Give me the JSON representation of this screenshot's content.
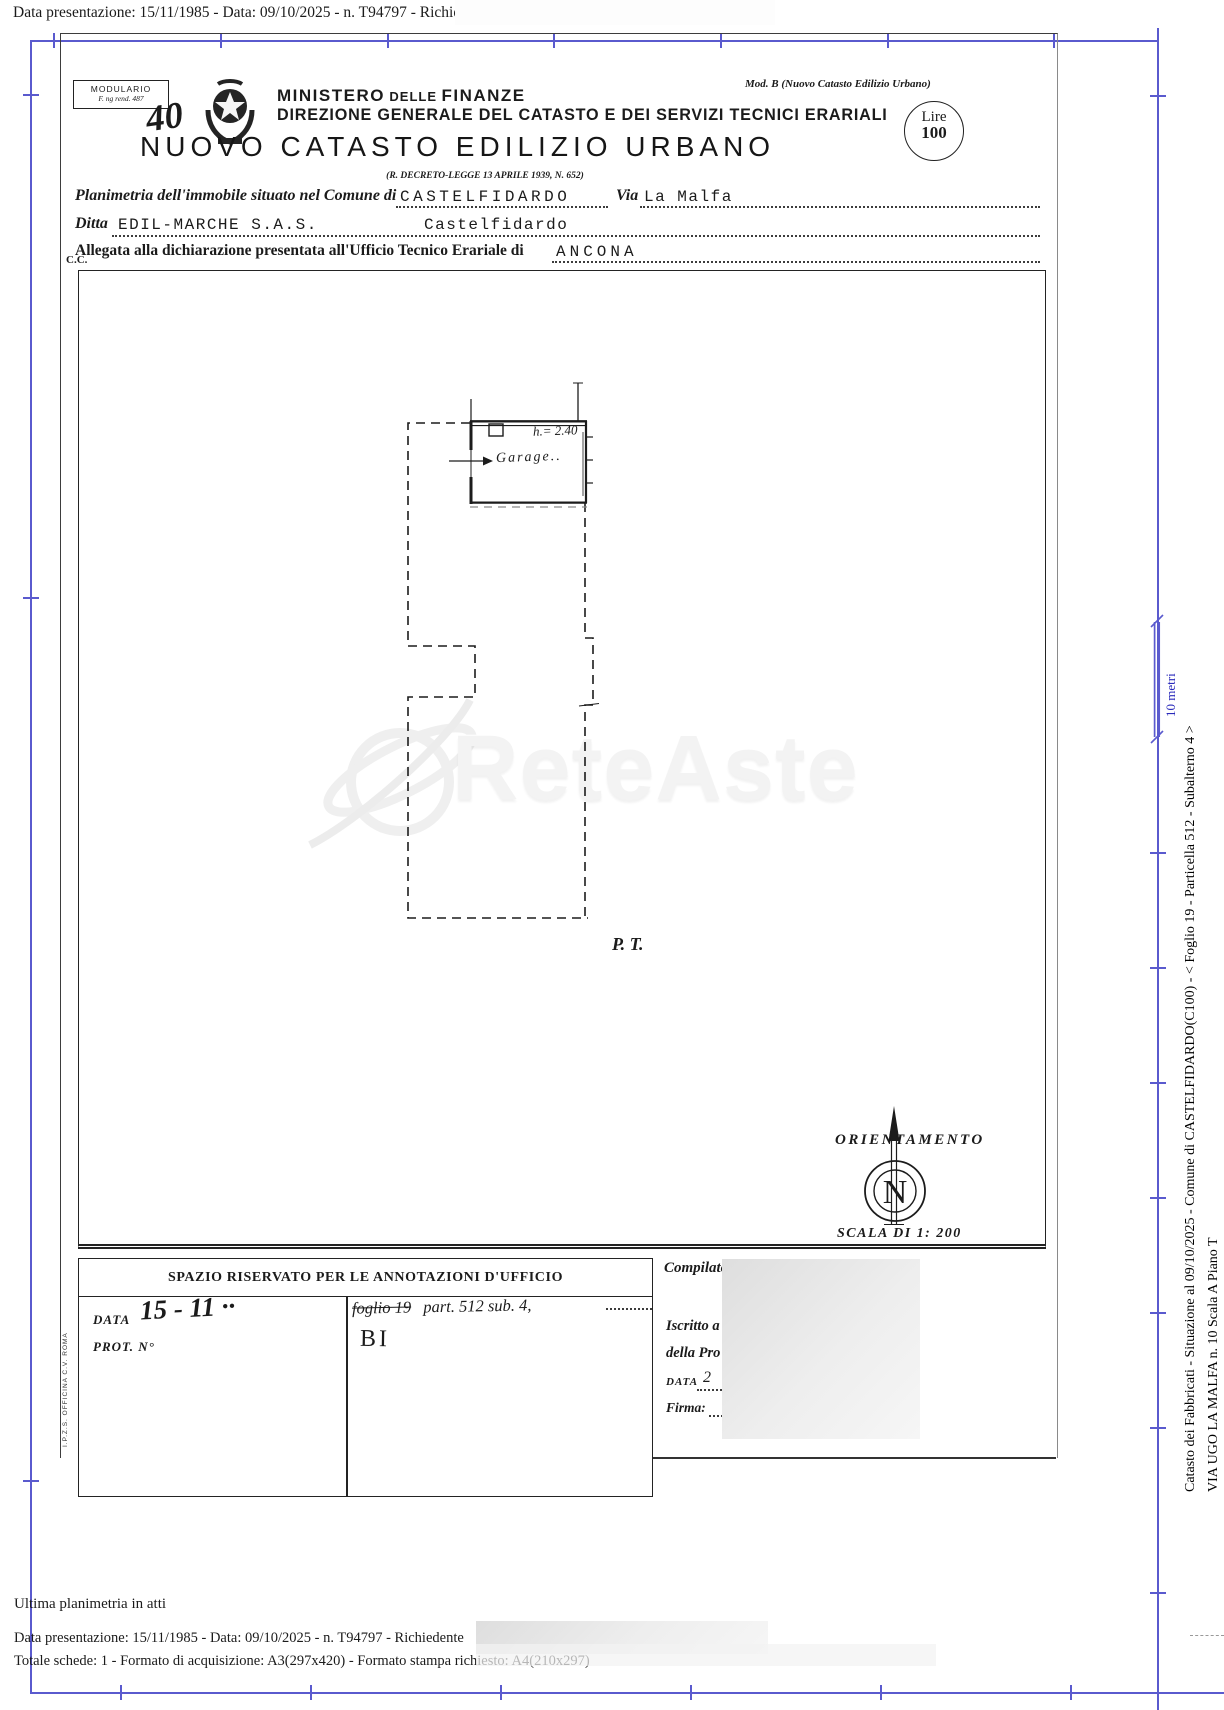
{
  "meta": {
    "top_line": "Data presentazione: 15/11/1985 - Data: 09/10/2025 - n. T94797 - Richiedente"
  },
  "header": {
    "modulario_1": "MODULARIO",
    "modulario_2": "F. ng rend. 487",
    "handwritten_number": "40",
    "ministry_1": "MINISTERO",
    "ministry_2": "DELLE",
    "ministry_3": "FINANZE",
    "direction": "DIREZIONE GENERALE DEL CATASTO E DEI SERVIZI TECNICI ERARIALI",
    "mod_b": "Mod. B (Nuovo Catasto Edilizio Urbano)",
    "lire_label": "Lire",
    "lire_value": "100",
    "title": "NUOVO CATASTO EDILIZIO URBANO",
    "decree": "(R. DECRETO-LEGGE 13 APRILE 1939, N. 652)"
  },
  "form": {
    "line1_label": "Planimetria dell'immobile situato nel Comune di",
    "comune_value": "CASTELFIDARDO",
    "via_label": "Via",
    "via_value": "La Malfa",
    "ditta_label": "Ditta",
    "ditta_value": "EDIL-MARCHE   S.A.S.",
    "ditta_value2": "Castelfidardo",
    "ufficio_label": "Allegata alla dichiarazione presentata all'Ufficio Tecnico Erariale di",
    "ufficio_value": "ANCONA",
    "cc": "C.C."
  },
  "plan": {
    "garage_label": "Garage..",
    "height_label": "h.= 2.40",
    "floor_label": "P. T.",
    "orientation_label": "ORIENTAMENTO",
    "north_letter": "N",
    "scale_label": "SCALA DI 1: 200"
  },
  "watermark": {
    "text": "ReteAste"
  },
  "annotations": {
    "title": "SPAZIO RISERVATO PER LE ANNOTAZIONI D'UFFICIO",
    "data_label": "DATA",
    "data_value": "15 - 11 ··",
    "prot_label": "PROT. N°",
    "foglio_struck": "foglio 19",
    "parcel_note": "part. 512  sub. 4,",
    "bi_note": "BI",
    "printer_mark": "I.P.Z.S.  OFFICINA C.V.  ROMA"
  },
  "office": {
    "compilato_label": "Compilato",
    "iscritto_label": "Iscritto a",
    "della_label": "della Pro",
    "data_label": "DATA",
    "data_mark": "2",
    "firma_label": "Firma:"
  },
  "sidebar": {
    "line1": "Catasto dei Fabbricati - Situazione al 09/10/2025 - Comune di CASTELFIDARDO(C100) - <  Foglio 19 - Particella  512 - Subalterno 4 >",
    "line2": "VIA UGO LA MALFA n. 10  Scala A Piano T",
    "scale_bar_label": "10 metri"
  },
  "footer": {
    "ultima": "Ultima planimetria in atti",
    "data_line": "Data presentazione: 15/11/1985 - Data: 09/10/2025 - n. T94797 - Richiedente",
    "totale_line": "Totale schede: 1 - Formato di acquisizione: A3(297x420)  - Formato stampa richiesto: A4(210x297)"
  }
}
